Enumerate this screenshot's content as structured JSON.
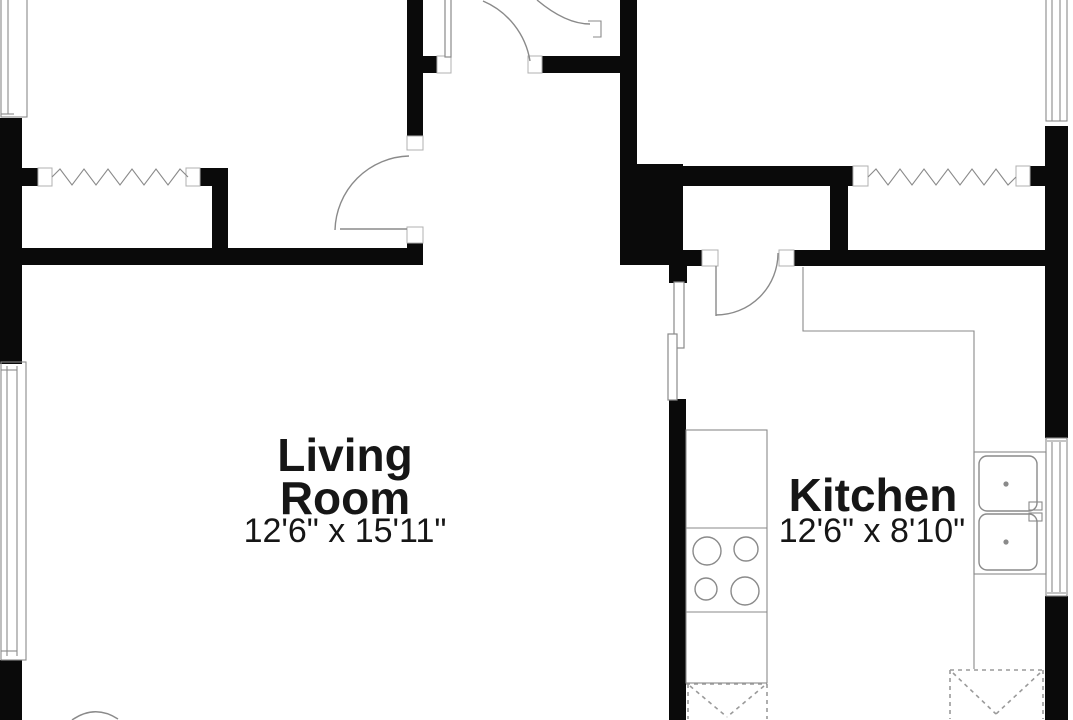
{
  "document": {
    "type": "residential floor plan (cropped view)"
  },
  "colors": {
    "background": "#ffffff",
    "wall": "#0a0a0a",
    "thin_line": "#8a8a8a",
    "jamb_line": "#b0b0b0",
    "dash_line": "#9a9a9a",
    "text": "#161616"
  },
  "rooms": {
    "living_room": {
      "label_line1": "Living",
      "label_line2": "Room",
      "dimensions": "12'6\" x 15'11\""
    },
    "kitchen": {
      "label": "Kitchen",
      "dimensions": "12'6\" x 8'10\""
    }
  },
  "fixtures": {
    "stove_burners": 4,
    "sink_basins": 2,
    "accordion_closets": 2,
    "dashed_appliance_symbols": 2,
    "door_swings": 5,
    "windows": 4
  }
}
